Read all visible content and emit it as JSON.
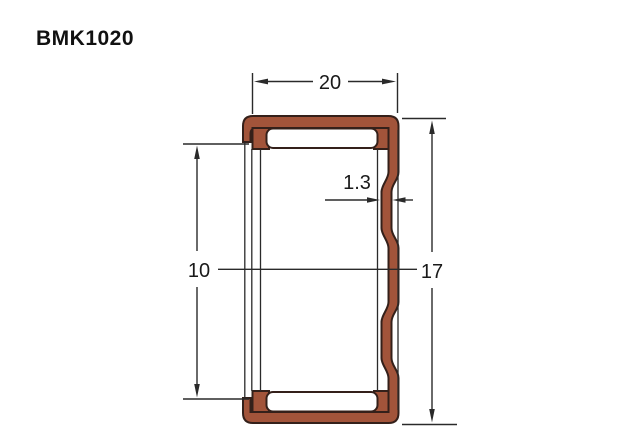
{
  "title": "BMK1020",
  "drawing": {
    "kind": "profile-cross-section",
    "colors": {
      "profile_fill": "#A2543A",
      "profile_stroke": "#34201A",
      "line_color": "#2A2A2A",
      "text_color": "#1A1A1A",
      "background": "#FFFFFF"
    },
    "dimensions": {
      "width": {
        "label": "20",
        "value": 20,
        "orientation": "horizontal",
        "position": "top"
      },
      "wall": {
        "label": "1.3",
        "value": 1.3,
        "orientation": "horizontal",
        "position": "right-wall"
      },
      "inner_height": {
        "label": "10",
        "value": 10,
        "orientation": "vertical",
        "position": "left"
      },
      "outer_height": {
        "label": "17",
        "value": 17,
        "orientation": "vertical",
        "position": "right"
      }
    }
  }
}
